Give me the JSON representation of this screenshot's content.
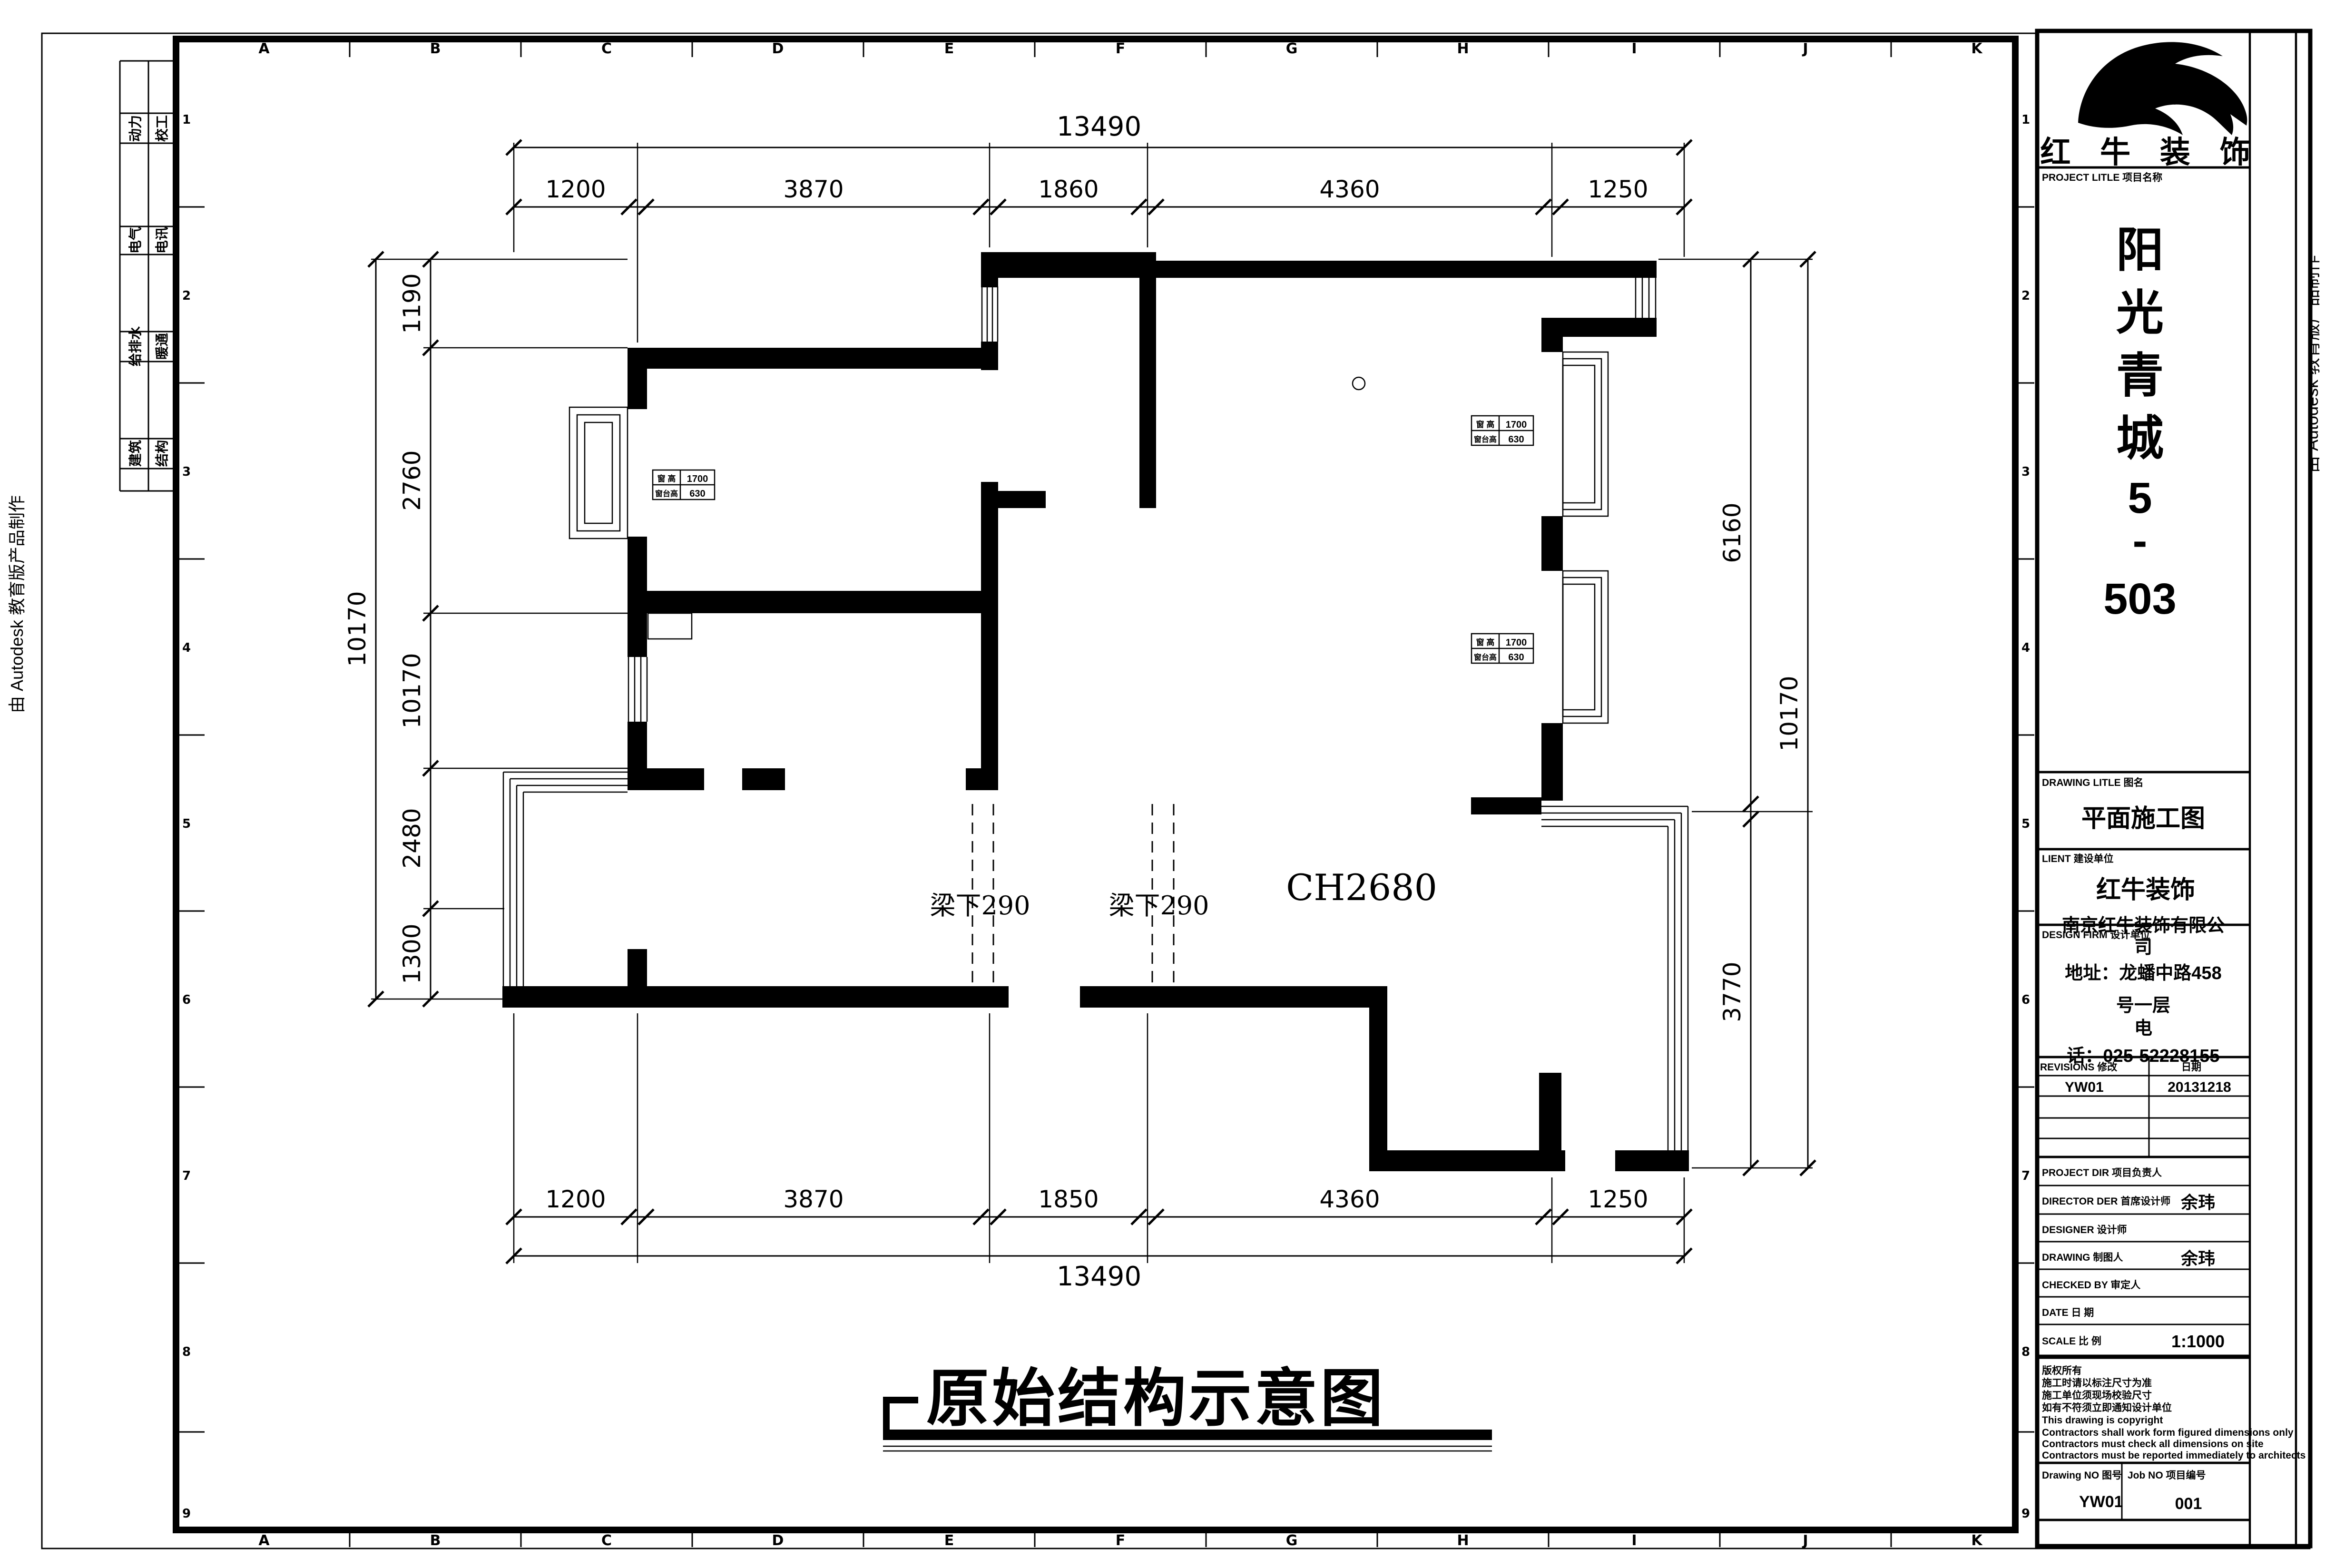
{
  "sheet": {
    "watermark": "由 Autodesk 教育版产品制作",
    "grid_letters": [
      "A",
      "B",
      "C",
      "D",
      "E",
      "F",
      "G",
      "H",
      "I",
      "J",
      "K"
    ],
    "grid_numbers": [
      "1",
      "2",
      "3",
      "4",
      "5",
      "6",
      "7",
      "8",
      "9"
    ],
    "discipline_table": [
      {
        "left": "动力",
        "right": "校工"
      },
      {
        "left": "电气",
        "right": "电讯"
      },
      {
        "left": "给排水",
        "right": "暖通"
      },
      {
        "left": "建筑",
        "right": "结构"
      }
    ]
  },
  "plan": {
    "title": "原始结构示意图",
    "ceiling_label": "CH2680",
    "beam_label_1": "梁下290",
    "beam_label_2": "梁下290",
    "window_tag": {
      "row1_label": "窗 高",
      "row1_value": "1700",
      "row2_label": "窗台高",
      "row2_value": "630"
    },
    "dims": {
      "top_total": "13490",
      "top_segments": [
        "1200",
        "3870",
        "1860",
        "4360",
        "1250"
      ],
      "bottom_segments": [
        "1200",
        "3870",
        "1850",
        "4360",
        "1250"
      ],
      "bottom_total": "13490",
      "left_outer_total": "10170",
      "left_segments": [
        "1190",
        "2760",
        "10170",
        "2480",
        "1300"
      ],
      "right_segments": [
        "6160",
        "3770"
      ],
      "right_outer_total": "10170"
    }
  },
  "title_block": {
    "logo_text": "红 牛 装 饰",
    "project_label": "PROJECT LITLE 项目名称",
    "project_name_chars": [
      "阳",
      "光",
      "青",
      "城",
      "5",
      "-",
      "503"
    ],
    "drawing_title_label": "DRAWING LITLE 图名",
    "drawing_title": "平面施工图",
    "client_label": "LIENT 建设单位",
    "client": "红牛装饰",
    "design_firm_label": "DESIGN FIRM 设计单位",
    "design_firm_lines": [
      "南京红牛装饰有限公",
      "司",
      "地址：龙蟠中路458",
      "号一层",
      "电",
      "话：025-52228155"
    ],
    "revisions_label": "REVISIONS 修改",
    "revisions_date_label": "日期",
    "revision_no": "YW01",
    "revision_date": "20131218",
    "project_dir_label": "PROJECT DIR  项目负责人",
    "director_label": "DIRECTOR DER 首席设计师",
    "director": "余玮",
    "designer_label": "DESIGNER  设计师",
    "drawing_by_label": "DRAWING  制图人",
    "drawing_by": "余玮",
    "checked_by_label": "CHECKED BY  审定人",
    "date_label": "DATE  日 期",
    "scale_label": "SCALE  比 例",
    "scale": "1:1000",
    "notes": [
      "版权所有",
      "施工时请以标注尺寸为准",
      "施工单位须现场校验尺寸",
      "如有不符须立即通知设计单位",
      "This drawing is copyright",
      "Contractors shall work form figured dimensions only",
      "Contractors must check all dimensions on site",
      "Contractors must be reported immediately to architects"
    ],
    "drawing_no_label": "Drawing NO  图号",
    "drawing_no": "YW01",
    "job_no_label": "Job NO  项目编号",
    "job_no": "001"
  }
}
